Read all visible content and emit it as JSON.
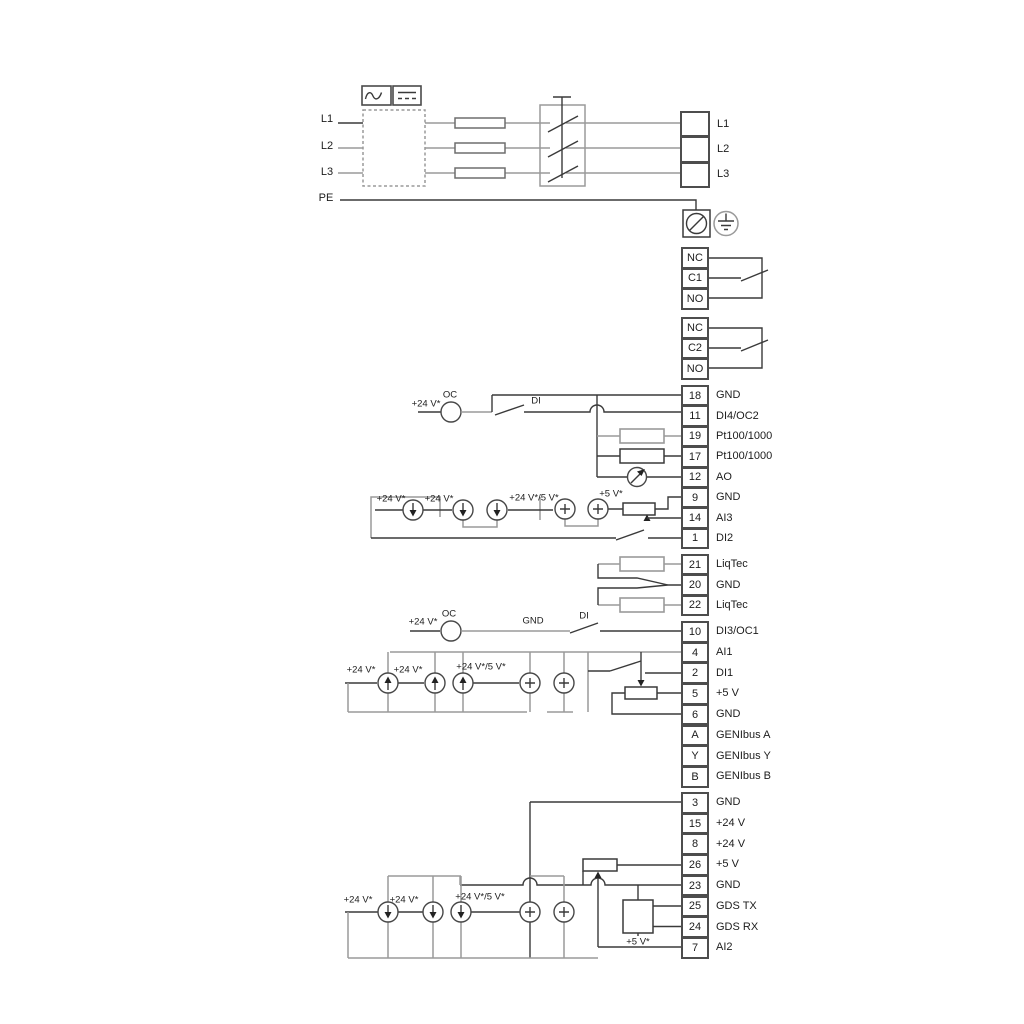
{
  "power": {
    "inputs": [
      "L1",
      "L2",
      "L3",
      "PE"
    ],
    "output_terminals": [
      {
        "num": "",
        "label": "L1"
      },
      {
        "num": "",
        "label": "L2"
      },
      {
        "num": "",
        "label": "L3"
      }
    ]
  },
  "relays": {
    "relay1": [
      "NC",
      "C1",
      "NO"
    ],
    "relay2": [
      "NC",
      "C2",
      "NO"
    ]
  },
  "terminals": {
    "io1": [
      {
        "num": "18",
        "label": "GND"
      },
      {
        "num": "11",
        "label": "DI4/OC2"
      },
      {
        "num": "19",
        "label": "Pt100/1000"
      },
      {
        "num": "17",
        "label": "Pt100/1000"
      },
      {
        "num": "12",
        "label": "AO"
      },
      {
        "num": "9",
        "label": "GND"
      },
      {
        "num": "14",
        "label": "AI3"
      },
      {
        "num": "1",
        "label": "DI2"
      }
    ],
    "liqtec": [
      {
        "num": "21",
        "label": "LiqTec"
      },
      {
        "num": "20",
        "label": "GND"
      },
      {
        "num": "22",
        "label": "LiqTec"
      }
    ],
    "io2": [
      {
        "num": "10",
        "label": "DI3/OC1"
      },
      {
        "num": "4",
        "label": "AI1"
      },
      {
        "num": "2",
        "label": "DI1"
      },
      {
        "num": "5",
        "label": "+5 V"
      },
      {
        "num": "6",
        "label": "GND"
      },
      {
        "num": "A",
        "label": "GENIbus A"
      },
      {
        "num": "Y",
        "label": "GENIbus Y"
      },
      {
        "num": "B",
        "label": "GENIbus B"
      }
    ],
    "io3": [
      {
        "num": "3",
        "label": "GND"
      },
      {
        "num": "15",
        "label": "+24 V"
      },
      {
        "num": "8",
        "label": "+24 V"
      },
      {
        "num": "26",
        "label": "+5 V"
      },
      {
        "num": "23",
        "label": "GND"
      },
      {
        "num": "25",
        "label": "GDS TX"
      },
      {
        "num": "24",
        "label": "GDS RX"
      },
      {
        "num": "7",
        "label": "AI2"
      }
    ]
  },
  "labels": {
    "v24": "+24 V*",
    "v24_5": "+24 V*/5 V*",
    "v5": "+5 V*",
    "oc": "OC",
    "di": "DI",
    "gnd": "GND"
  },
  "icons": {
    "ac_icon": "sine-wave",
    "dc_icon": "dashed-lines",
    "pe_terminal_icon": "circle-slash",
    "earth_icon": "ground-symbol",
    "current_sink_icon": "circle-down-arrow",
    "current_source_icon": "circle-up-arrow",
    "voltage_source_icon": "circle-plus",
    "ao_meter_icon": "circle-needle",
    "potentiometer_icon": "resistor-wiper",
    "main_switch_icon": "three-pole-switch"
  }
}
